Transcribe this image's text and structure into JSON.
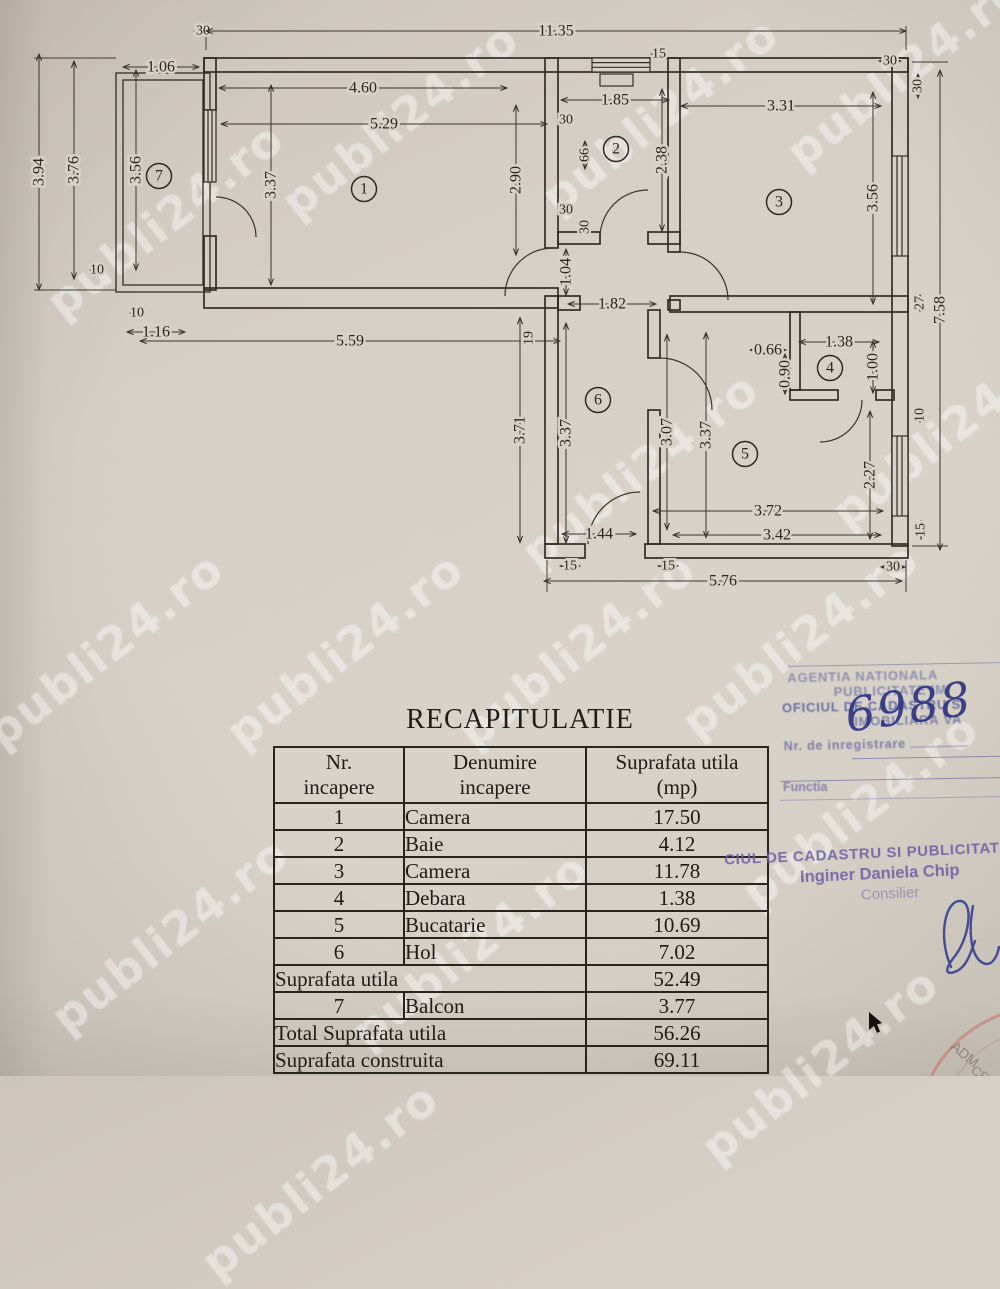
{
  "watermark": {
    "text": "publi24.ro"
  },
  "plan": {
    "rooms": [
      {
        "n": "1",
        "x": 364,
        "y": 189
      },
      {
        "n": "2",
        "x": 616,
        "y": 149
      },
      {
        "n": "3",
        "x": 779,
        "y": 202
      },
      {
        "n": "4",
        "x": 830,
        "y": 368
      },
      {
        "n": "5",
        "x": 745,
        "y": 454
      },
      {
        "n": "6",
        "x": 598,
        "y": 400
      },
      {
        "n": "7",
        "x": 159,
        "y": 176
      }
    ],
    "dims": [
      {
        "t": "30",
        "x": 203,
        "y": 31,
        "len": 18
      },
      {
        "t": "11.35",
        "x": 556,
        "y": 31,
        "len": 700
      },
      {
        "t": "15",
        "x": 659,
        "y": 54,
        "len": 16
      },
      {
        "t": "30",
        "x": 890,
        "y": 61,
        "len": 22
      },
      {
        "t": "30",
        "x": 918,
        "y": 86,
        "len": 24,
        "v": 1
      },
      {
        "t": "1.06",
        "x": 161,
        "y": 67,
        "len": 76
      },
      {
        "t": "3.94",
        "x": 39,
        "y": 172,
        "len": 236,
        "v": 1
      },
      {
        "t": "3.76",
        "x": 74,
        "y": 170,
        "len": 218,
        "v": 1
      },
      {
        "t": "3.56",
        "x": 136,
        "y": 170,
        "len": 200,
        "v": 1
      },
      {
        "t": "4.60",
        "x": 363,
        "y": 88,
        "len": 288
      },
      {
        "t": "5.29",
        "x": 384,
        "y": 124,
        "len": 326
      },
      {
        "t": "3.37",
        "x": 271,
        "y": 185,
        "len": 200,
        "v": 1
      },
      {
        "t": "2.90",
        "x": 516,
        "y": 180,
        "len": 150,
        "v": 1
      },
      {
        "t": "1.85",
        "x": 615,
        "y": 100,
        "len": 108
      },
      {
        "t": "30",
        "x": 566,
        "y": 120,
        "len": 16
      },
      {
        "t": "66",
        "x": 585,
        "y": 155,
        "len": 28,
        "v": 1
      },
      {
        "t": "2.38",
        "x": 662,
        "y": 160,
        "len": 142,
        "v": 1
      },
      {
        "t": "30",
        "x": 566,
        "y": 210,
        "len": 16
      },
      {
        "t": "30",
        "x": 585,
        "y": 227,
        "len": 14,
        "v": 1
      },
      {
        "t": "3.31",
        "x": 781,
        "y": 106,
        "len": 200
      },
      {
        "t": "3.56",
        "x": 873,
        "y": 198,
        "len": 212,
        "v": 1
      },
      {
        "t": "27",
        "x": 920,
        "y": 303,
        "len": 16,
        "v": 1
      },
      {
        "t": "7.58",
        "x": 940,
        "y": 310,
        "len": 480,
        "v": 1
      },
      {
        "t": "1.04",
        "x": 566,
        "y": 272,
        "len": 46,
        "v": 1
      },
      {
        "t": "1.82",
        "x": 612,
        "y": 304,
        "len": 88
      },
      {
        "t": "10",
        "x": 97,
        "y": 270,
        "len": 14
      },
      {
        "t": "10",
        "x": 137,
        "y": 313,
        "len": 14
      },
      {
        "t": "1.16",
        "x": 156,
        "y": 332,
        "len": 58
      },
      {
        "t": "5.59",
        "x": 350,
        "y": 341,
        "len": 420
      },
      {
        "t": "19",
        "x": 529,
        "y": 338,
        "len": 10,
        "v": 1
      },
      {
        "t": "3.71",
        "x": 520,
        "y": 430,
        "len": 225,
        "v": 1
      },
      {
        "t": "3.37",
        "x": 566,
        "y": 433,
        "len": 220,
        "v": 1
      },
      {
        "t": "3.07",
        "x": 667,
        "y": 432,
        "len": 195,
        "v": 1
      },
      {
        "t": "3.37",
        "x": 706,
        "y": 435,
        "len": 205,
        "v": 1
      },
      {
        "t": "0.66",
        "x": 768,
        "y": 350,
        "len": 36
      },
      {
        "t": "0.90",
        "x": 785,
        "y": 374,
        "len": 40,
        "v": 1
      },
      {
        "t": "1.38",
        "x": 839,
        "y": 342,
        "len": 80
      },
      {
        "t": "1.00",
        "x": 873,
        "y": 367,
        "len": 52,
        "v": 1
      },
      {
        "t": "10",
        "x": 920,
        "y": 415,
        "len": 14,
        "v": 1
      },
      {
        "t": "2.27",
        "x": 870,
        "y": 475,
        "len": 128,
        "v": 1
      },
      {
        "t": "3.72",
        "x": 768,
        "y": 511,
        "len": 230
      },
      {
        "t": "3.42",
        "x": 777,
        "y": 535,
        "len": 208
      },
      {
        "t": "1.44",
        "x": 599,
        "y": 534,
        "len": 74
      },
      {
        "t": "15",
        "x": 570,
        "y": 566,
        "len": 20
      },
      {
        "t": "15",
        "x": 668,
        "y": 566,
        "len": 20
      },
      {
        "t": "15",
        "x": 921,
        "y": 530,
        "len": 18,
        "v": 1
      },
      {
        "t": "30",
        "x": 893,
        "y": 567,
        "len": 24
      },
      {
        "t": "5.76",
        "x": 723,
        "y": 581,
        "len": 358
      }
    ]
  },
  "recap": {
    "title": "RECAPITULATIE",
    "columns": [
      {
        "l1": "Nr.",
        "l2": "incapere"
      },
      {
        "l1": "Denumire",
        "l2": "incapere"
      },
      {
        "l1": "Suprafata utila",
        "l2": "(mp)"
      }
    ],
    "rows": [
      {
        "nr": "1",
        "name": "Camera",
        "area": "17.50"
      },
      {
        "nr": "2",
        "name": "Baie",
        "area": "4.12"
      },
      {
        "nr": "3",
        "name": "Camera",
        "area": "11.78"
      },
      {
        "nr": "4",
        "name": "Debara",
        "area": "1.38"
      },
      {
        "nr": "5",
        "name": "Bucatarie",
        "area": "10.69"
      },
      {
        "nr": "6",
        "name": "Hol",
        "area": "7.02"
      },
      {
        "label": "Suprafata utila",
        "area": "52.49"
      },
      {
        "nr": "7",
        "name": "Balcon",
        "area": "3.77"
      },
      {
        "label": "Total Suprafata utila",
        "area": "56.26"
      },
      {
        "label": "Suprafata construita",
        "area": "69.11"
      }
    ]
  },
  "stamps": {
    "registry": {
      "line1": "AGENTIA NATIONALA",
      "line2": "PUBLICITATE IM",
      "line3": "OFICIUL DE CADASTRU S",
      "line4": "IMOBILIARA VA",
      "reg_label": "Nr. de inregistrare",
      "number": "6988",
      "functie": "Functia"
    },
    "office": {
      "line1": "CIUL DE CADASTRU SI PUBLICITATE I",
      "line2": "Inginer Daniela Chip",
      "line3": "Consilier"
    },
    "round_seal": {
      "letters_top": "ADM",
      "letters_bottom": "CE"
    }
  }
}
